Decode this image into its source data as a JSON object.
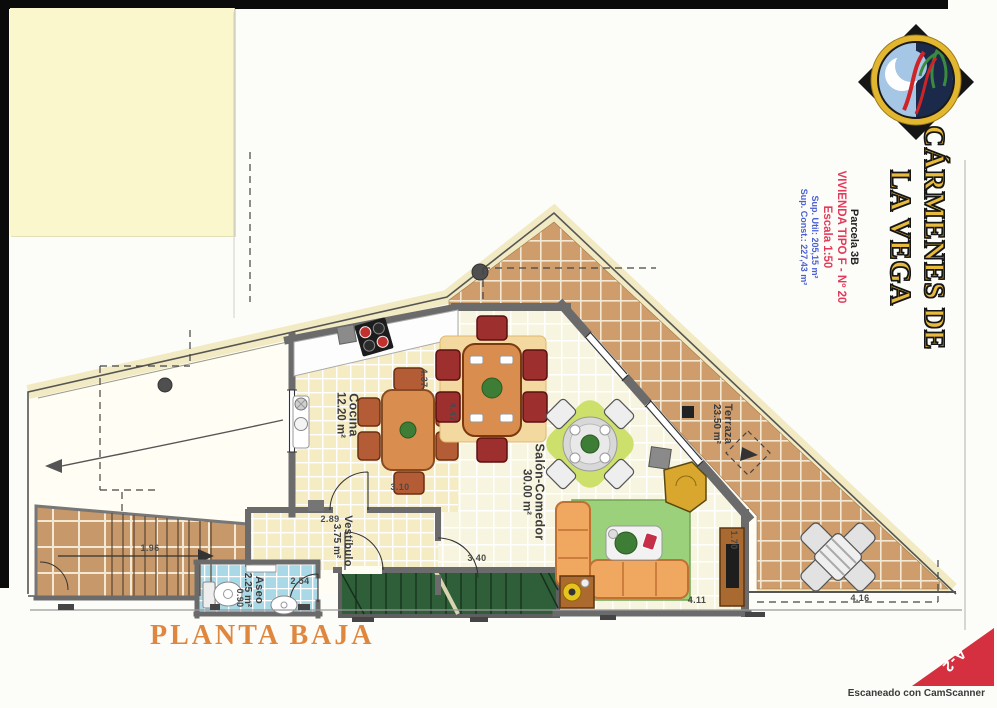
{
  "document": {
    "plan_title": "PLANTA BAJA",
    "sheet_code": "A-2",
    "scanner_watermark": "Escaneado con CamScanner"
  },
  "title_block": {
    "brand_line1": "CÁRMENES DE",
    "brand_line2": "LA VEGA",
    "parcela": "Parcela 3B",
    "vivienda_tipo": "VIVIENDA TIPO F - Nº 20",
    "escala": "Escala 1:50",
    "sup_util": "Sup. Util: 205,15 m²",
    "sup_const": "Sup. Const.: 227,43 m²"
  },
  "plan": {
    "rooms": [
      {
        "name": "Cocina",
        "area": "12.20 m²"
      },
      {
        "name": "Salón-Comedor",
        "area": "30.00 m²"
      },
      {
        "name": "Vestíbulo",
        "area": "3.75 m²"
      },
      {
        "name": "Aseo",
        "area": "2.25 m²"
      },
      {
        "name": "Terraza",
        "area": "23.50 m²"
      }
    ],
    "dimensions": [
      "4.37",
      "4.47",
      "3.10",
      "2.89",
      "1.96",
      "2.54",
      "0.90",
      "3.40",
      "4.11",
      "1.70",
      "4.16"
    ]
  },
  "colors": {
    "brand_gold": "#e9bb3d",
    "accent_red": "#e23a5a",
    "accent_blue": "#4a5fd0",
    "plan_title_orange": "#e0873f",
    "corner_red": "#d5303f",
    "terrace_tile": "#cf9c6c",
    "aseo_tile": "#a9d9e6",
    "stair_green": "#2f5f38",
    "sticky_note": "#faf7cd"
  }
}
